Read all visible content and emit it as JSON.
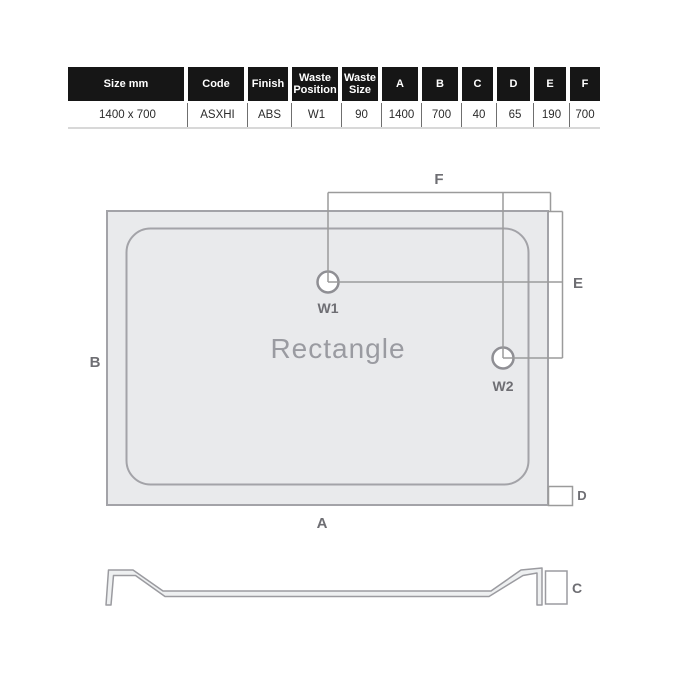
{
  "colors": {
    "table_header_bg": "#161616",
    "table_header_text": "#ffffff",
    "tray_fill": "#e9eaec",
    "tray_stroke": "#a3a3a8",
    "dimension_line": "#9b9b9b",
    "dimension_label": "#6e6e73",
    "shape_label_text": "#9a9ba1"
  },
  "spec_table": {
    "columns": [
      {
        "header": "Size mm",
        "value": "1400 x 700",
        "width": 116
      },
      {
        "header": "Code",
        "value": "ASXHI",
        "width": 56
      },
      {
        "header": "Finish",
        "value": "ABS",
        "width": 40
      },
      {
        "header": "Waste Position",
        "value": "W1",
        "width": 46
      },
      {
        "header": "Waste Size",
        "value": "90",
        "width": 36
      },
      {
        "header": "A",
        "value": "1400",
        "width": 36
      },
      {
        "header": "B",
        "value": "700",
        "width": 36
      },
      {
        "header": "C",
        "value": "40",
        "width": 31
      },
      {
        "header": "D",
        "value": "65",
        "width": 33
      },
      {
        "header": "E",
        "value": "190",
        "width": 32
      },
      {
        "header": "F",
        "value": "700",
        "width": 30
      }
    ]
  },
  "diagram": {
    "shape_label": "Rectangle",
    "waste1_label": "W1",
    "waste2_label": "W2",
    "dim_a": "A",
    "dim_b": "B",
    "dim_c": "C",
    "dim_d": "D",
    "dim_e": "E",
    "dim_f": "F"
  }
}
